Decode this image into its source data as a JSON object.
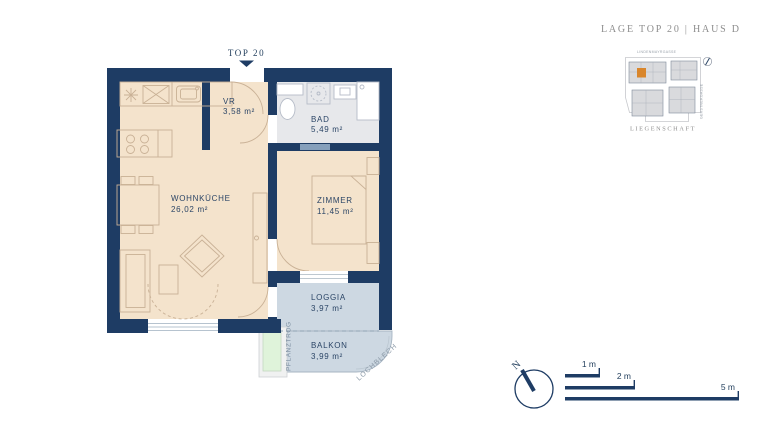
{
  "header": {
    "title": "LAGE TOP 20  |  HAUS D"
  },
  "plan": {
    "unit_label": "TOP 20",
    "rooms": {
      "vr": {
        "name": "VR",
        "area": "3,58 m²"
      },
      "bad": {
        "name": "BAD",
        "area": "5,49 m²"
      },
      "wohnkueche": {
        "name": "WOHNKÜCHE",
        "area": "26,02 m²"
      },
      "zimmer": {
        "name": "ZIMMER",
        "area": "11,45 m²"
      },
      "loggia": {
        "name": "LOGGIA",
        "area": "3,97 m²"
      },
      "balkon": {
        "name": "BALKON",
        "area": "3,99 m²"
      }
    },
    "annotations": {
      "pflanztrog": "PFLANZTROG",
      "lochblech": "LOCHBLECH"
    }
  },
  "site_plan": {
    "street_top": "LINDENMAYRGASSE",
    "street_right": "GERSTNERGASSE",
    "caption": "LIEGENSCHAFT",
    "highlight_color": "#d9862c"
  },
  "legend": {
    "north_label": "N",
    "scale_bars": [
      {
        "label": "1 m"
      },
      {
        "label": "2 m"
      },
      {
        "label": "5 m"
      }
    ]
  },
  "colors": {
    "wall": "#1e3c64",
    "floor": "#f4e3cc",
    "bath_floor": "#e7e8eb",
    "outdoor_floor": "#cdd8e2",
    "planter": "#dff3da",
    "accent": "#d9862c"
  }
}
